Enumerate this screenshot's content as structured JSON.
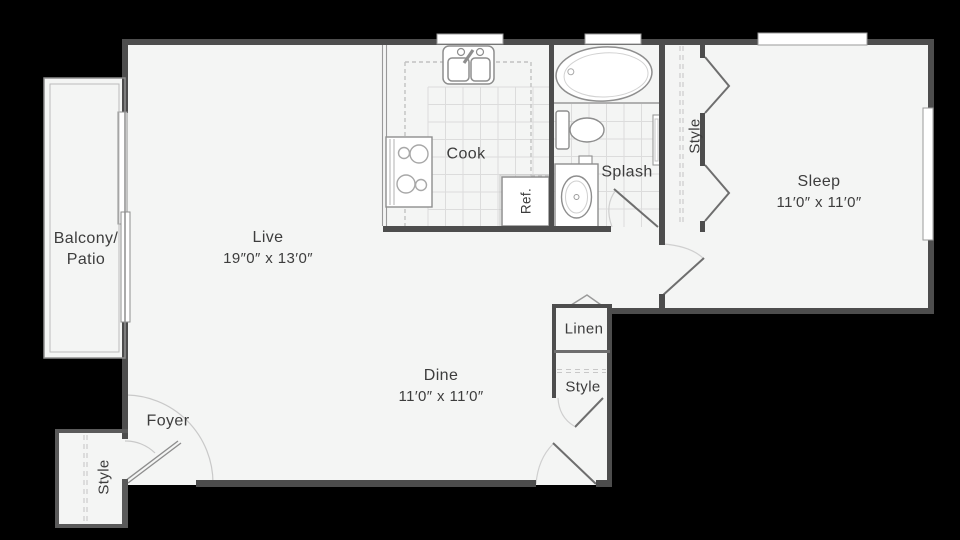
{
  "floor_plan": {
    "background_color": "#000000",
    "floor_color": "#f4f5f4",
    "wall_color": "#4d4d4d",
    "fixture_line_color": "#8e8e8e",
    "tile_line_color": "#dcdcdc",
    "rooms": {
      "balcony": {
        "label_line1": "Balcony/",
        "label_line2": "Patio"
      },
      "live": {
        "name": "Live",
        "dims": "19″0″ x 13′0″"
      },
      "cook": {
        "name": "Cook"
      },
      "refrigerator": {
        "name": "Ref."
      },
      "splash": {
        "name": "Splash"
      },
      "bedroom_closet": {
        "name": "Style"
      },
      "sleep": {
        "name": "Sleep",
        "dims": "11′0″ x 11′0″"
      },
      "linen": {
        "name": "Linen"
      },
      "hall_closet": {
        "name": "Style"
      },
      "dine": {
        "name": "Dine",
        "dims": "11′0″ x 11′0″"
      },
      "foyer": {
        "name": "Foyer"
      },
      "entry_closet": {
        "name": "Style"
      }
    }
  }
}
